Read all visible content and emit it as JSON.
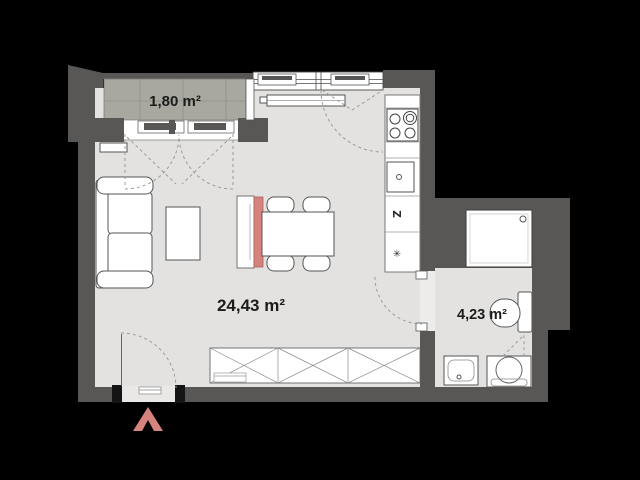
{
  "plan_type": "apartment-floor-plan",
  "rooms": {
    "balcony": {
      "area_label": "1,80 m²"
    },
    "living_room": {
      "area_label": "24,43 m²"
    },
    "bathroom": {
      "area_label": "4,23 m²"
    }
  },
  "kitchen": {
    "z_label": "Z",
    "fridge_symbol": "✳"
  },
  "colors": {
    "background": "#000000",
    "wall": "#595755",
    "floor": "#e3e2e0",
    "balcony_tile": "#a8a8a0",
    "accent_red": "#d5837c",
    "fixture_outline": "#555555",
    "dashed_line": "#9b9b97",
    "label_text": "#1b1b1b"
  }
}
